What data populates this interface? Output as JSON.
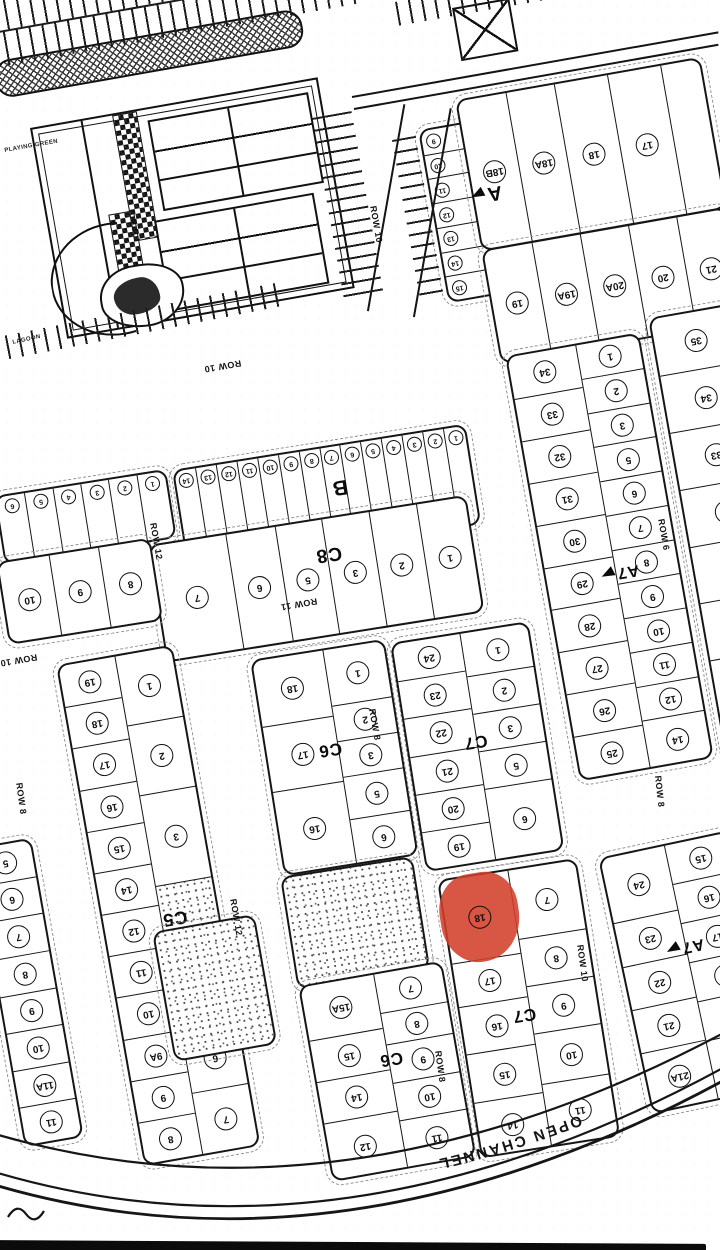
{
  "meta": {
    "description_label": "scanned plot map with highlighted plot"
  },
  "highlight": {
    "plot_number": "18",
    "section": "C7",
    "color": "#d2402a"
  },
  "decor_labels": {
    "playing_green": "PLAYING GREEN",
    "lagoon": "LAGOON"
  },
  "map": {
    "channel_label": "OPEN CHANNEL",
    "blocks": [
      {
        "name": "section-a-small-plots",
        "x": 418,
        "y": 130,
        "w": 48,
        "h": 172,
        "rot": -10,
        "small": true,
        "numleft": true,
        "cols": [
          {
            "w": 1,
            "cells": [
              "9",
              "10",
              "11",
              "12",
              "13",
              "14",
              "15"
            ]
          }
        ]
      },
      {
        "name": "section-a-row1",
        "x": 455,
        "y": 100,
        "w": 245,
        "h": 150,
        "rot": -10,
        "label": "A",
        "lx": 4,
        "ly": 64,
        "ls": 20,
        "arrow": true,
        "colw": [
          0.2,
          0.2,
          0.22,
          0.22,
          0.16
        ],
        "row": [
          "18B",
          "18A",
          "18",
          "17",
          ""
        ]
      },
      {
        "name": "section-a-row2",
        "x": 481,
        "y": 250,
        "w": 245,
        "h": 112,
        "rot": -10,
        "row": [
          "19",
          "19A",
          "20A",
          "20",
          "21"
        ]
      },
      {
        "name": "section-b",
        "x": 172,
        "y": 470,
        "w": 293,
        "h": 98,
        "rot": -9,
        "small": true,
        "numtop": true,
        "label": "B",
        "lx": 55,
        "ly": 42,
        "ls": 21,
        "row": [
          "14",
          "13",
          "12",
          "11",
          "10",
          "9",
          "8",
          "7",
          "6",
          "5",
          "4",
          "3",
          "2",
          "1"
        ]
      },
      {
        "name": "section-b-left",
        "x": -6,
        "y": 496,
        "w": 170,
        "h": 66,
        "rot": -9,
        "small": true,
        "numtop": true,
        "row": [
          "6",
          "5",
          "4",
          "3",
          "2",
          "1"
        ]
      },
      {
        "name": "section-c8",
        "x": 148,
        "y": 545,
        "w": 318,
        "h": 115,
        "rot": -9,
        "label": "C8",
        "lx": 55,
        "ly": 30,
        "ls": 19,
        "colw": [
          0.24,
          0.155,
          0.15,
          0.15,
          0.15,
          0.155
        ],
        "row": [
          "7",
          "6",
          "5",
          "3",
          "2",
          "1"
        ]
      },
      {
        "name": "section-c8-left",
        "x": -4,
        "y": 562,
        "w": 152,
        "h": 80,
        "rot": -9,
        "row": [
          "10",
          "9",
          "8"
        ]
      },
      {
        "name": "section-c5",
        "x": 56,
        "y": 665,
        "w": 114,
        "h": 505,
        "rot": -10,
        "label": "C5",
        "lx": 62,
        "ly": 53,
        "ls": 18,
        "cols": [
          {
            "w": 0.5,
            "cells": [
              "19",
              "18",
              "17",
              "16",
              "15",
              "14",
              "12",
              "11",
              "10",
              "9A",
              "9",
              "8"
            ]
          },
          {
            "w": 0.5,
            "cells": [
              {
                "n": "1",
                "h": 1.15
              },
              {
                "n": "2",
                "h": 1.15
              },
              {
                "n": "3",
                "h": 1.5
              },
              {
                "n": "",
                "stipple": true,
                "h": 1.4
              },
              "5",
              "6",
              "7"
            ]
          }
        ]
      },
      {
        "name": "section-c5-edge",
        "x": -28,
        "y": 848,
        "w": 56,
        "h": 300,
        "rot": -10,
        "cols": [
          {
            "w": 1,
            "cells": [
              "5",
              "6",
              "7",
              "8",
              "9",
              "10",
              "11A",
              "11"
            ]
          }
        ]
      },
      {
        "name": "stipple-area-c5",
        "x": 152,
        "y": 932,
        "w": 100,
        "h": 128,
        "rot": -10,
        "cols": [
          {
            "w": 1,
            "cells": [
              {
                "n": "",
                "stipple": true
              }
            ]
          }
        ]
      },
      {
        "name": "section-c6-upper",
        "x": 250,
        "y": 660,
        "w": 132,
        "h": 215,
        "rot": -9,
        "label": "C6",
        "lx": 48,
        "ly": 46,
        "ls": 17,
        "cols": [
          {
            "w": 0.54,
            "cells": [
              "18",
              "17",
              {
                "n": "16",
                "h": 1.25
              }
            ]
          },
          {
            "w": 0.46,
            "cells": [
              {
                "n": "1",
                "h": 1.35
              },
              {
                "n": "2",
                "h": 0.85
              },
              {
                "n": "3",
                "h": 0.85
              },
              "5",
              {
                "n": "6",
                "h": 1.05
              }
            ]
          }
        ]
      },
      {
        "name": "stipple-area-c6",
        "x": 280,
        "y": 877,
        "w": 130,
        "h": 110,
        "rot": -9,
        "cols": [
          {
            "w": 1,
            "cells": [
              {
                "n": "",
                "stipple": true
              }
            ]
          }
        ]
      },
      {
        "name": "section-c7-upper",
        "x": 390,
        "y": 643,
        "w": 136,
        "h": 228,
        "rot": -9,
        "label": "C7",
        "lx": 49,
        "ly": 48,
        "ls": 17,
        "cols": [
          {
            "w": 0.5,
            "cells": [
              "24",
              "23",
              "22",
              "21",
              "20",
              "19"
            ]
          },
          {
            "w": 0.5,
            "cells": [
              {
                "n": "1",
                "h": 1.15
              },
              "2",
              "3",
              "5",
              {
                "n": "6",
                "h": 1.9
              }
            ]
          }
        ]
      },
      {
        "name": "section-c7-lower",
        "x": 437,
        "y": 880,
        "w": 137,
        "h": 278,
        "rot": -9,
        "label": "C7",
        "lx": 46,
        "ly": 52,
        "ls": 17,
        "cols": [
          {
            "w": 0.5,
            "cells": [
              {
                "n": "18",
                "red": true,
                "h": 1.65
              },
              {
                "n": "17",
                "h": 0.85
              },
              {
                "n": "16",
                "h": 0.95
              },
              {
                "n": "15",
                "h": 0.95
              },
              {
                "n": "14",
                "h": 1.05
              }
            ]
          },
          {
            "w": 0.5,
            "cells": [
              {
                "n": "7",
                "h": 1.3
              },
              {
                "n": "8",
                "h": 0.9
              },
              {
                "n": "9",
                "h": 0.9
              },
              {
                "n": "10",
                "h": 0.95
              },
              {
                "n": "11",
                "h": 1.15
              }
            ]
          }
        ]
      },
      {
        "name": "section-c6-lower",
        "x": 298,
        "y": 986,
        "w": 142,
        "h": 195,
        "rot": -10,
        "label": "C6",
        "lx": 54,
        "ly": 44,
        "ls": 17,
        "cols": [
          {
            "w": 0.52,
            "cells": [
              {
                "n": "15A",
                "h": 1.3
              },
              "15",
              "14",
              {
                "n": "12",
                "h": 1.35
              }
            ]
          },
          {
            "w": 0.48,
            "cells": [
              {
                "n": "7",
                "h": 1.05
              },
              {
                "n": "8",
                "h": 0.85
              },
              "9",
              "10",
              {
                "n": "11",
                "h": 1.25
              }
            ]
          }
        ]
      },
      {
        "name": "section-a7-upper",
        "x": 505,
        "y": 356,
        "w": 132,
        "h": 428,
        "rot": -10,
        "label": "A7",
        "lx": 54,
        "ly": 54,
        "ls": 16,
        "arrow": true,
        "cols": [
          {
            "w": 0.52,
            "cells": [
              "34",
              "33",
              "32",
              "31",
              "30",
              "29",
              "28",
              "27",
              "26",
              "25"
            ]
          },
          {
            "w": 0.48,
            "cells": [
              "1",
              "2",
              "3",
              "5",
              "6",
              "7",
              "8",
              "9",
              "10",
              "11",
              "12",
              {
                "n": "14",
                "h": 1.35
              }
            ]
          }
        ]
      },
      {
        "name": "right-edge-column",
        "x": 648,
        "y": 318,
        "w": 82,
        "h": 462,
        "rot": -10,
        "cols": [
          {
            "w": 1,
            "cells": [
              "35",
              "34",
              "33",
              "32",
              "31",
              "30",
              "29",
              "28"
            ]
          }
        ]
      },
      {
        "name": "section-a7-lower",
        "x": 598,
        "y": 858,
        "w": 130,
        "h": 258,
        "rot": -12,
        "label": "A7",
        "lx": 48,
        "ly": 40,
        "ls": 16,
        "arrow": true,
        "cols": [
          {
            "w": 0.5,
            "cells": [
              {
                "n": "24",
                "h": 1.5
              },
              "23",
              "22",
              "21",
              {
                "n": "21A",
                "h": 1.35
              }
            ]
          },
          {
            "w": 0.5,
            "cells": [
              "15",
              "16",
              "17",
              "18",
              "19",
              {
                "n": "20",
                "h": 1.5
              }
            ]
          }
        ]
      }
    ],
    "road_labels": [
      {
        "text": "ROW 10",
        "x": 378,
        "y": 205,
        "rot": 80
      },
      {
        "text": "ROW 10",
        "x": 242,
        "y": 368,
        "rot": 170
      },
      {
        "text": "ROW 10",
        "x": 38,
        "y": 662,
        "rot": 170
      },
      {
        "text": "ROW 11",
        "x": 318,
        "y": 606,
        "rot": 170
      },
      {
        "text": "ROW 12",
        "x": 158,
        "y": 522,
        "rot": 80
      },
      {
        "text": "ROW 12",
        "x": 238,
        "y": 898,
        "rot": 80
      },
      {
        "text": "ROW 8",
        "x": 24,
        "y": 782,
        "rot": 82
      },
      {
        "text": "ROW 8",
        "x": 377,
        "y": 708,
        "rot": 80
      },
      {
        "text": "ROW 8",
        "x": 443,
        "y": 1050,
        "rot": 82
      },
      {
        "text": "ROW 8",
        "x": 663,
        "y": 775,
        "rot": 84
      },
      {
        "text": "ROW 6",
        "x": 666,
        "y": 518,
        "rot": 80
      },
      {
        "text": "ROW 10",
        "x": 585,
        "y": 944,
        "rot": 82
      }
    ],
    "lines": [
      {
        "x": 352,
        "y": 96,
        "len": 372,
        "rot": -10
      },
      {
        "x": 354,
        "y": 108,
        "len": 370,
        "rot": -10
      },
      {
        "x": 368,
        "y": 310,
        "len": 210,
        "rot": -80
      },
      {
        "x": 414,
        "y": 316,
        "len": 212,
        "rot": -80
      }
    ],
    "combs": [
      {
        "x": -10,
        "y": 2,
        "w": 372,
        "h": 30,
        "rot": -10,
        "dir": "v",
        "aisle": true
      },
      {
        "x": -10,
        "y": 34,
        "w": 372,
        "h": 34,
        "rot": -10,
        "dir": "v"
      },
      {
        "x": 395,
        "y": 2,
        "w": 245,
        "h": 24,
        "rot": -10,
        "dir": "v"
      },
      {
        "x": 312,
        "y": 118,
        "w": 40,
        "h": 185,
        "rot": -10,
        "dir": "h"
      },
      {
        "x": -8,
        "y": 338,
        "w": 295,
        "h": 24,
        "rot": -11,
        "dir": "v"
      },
      {
        "x": 392,
        "y": 140,
        "w": 24,
        "h": 160,
        "rot": -10,
        "dir": "h"
      }
    ]
  }
}
